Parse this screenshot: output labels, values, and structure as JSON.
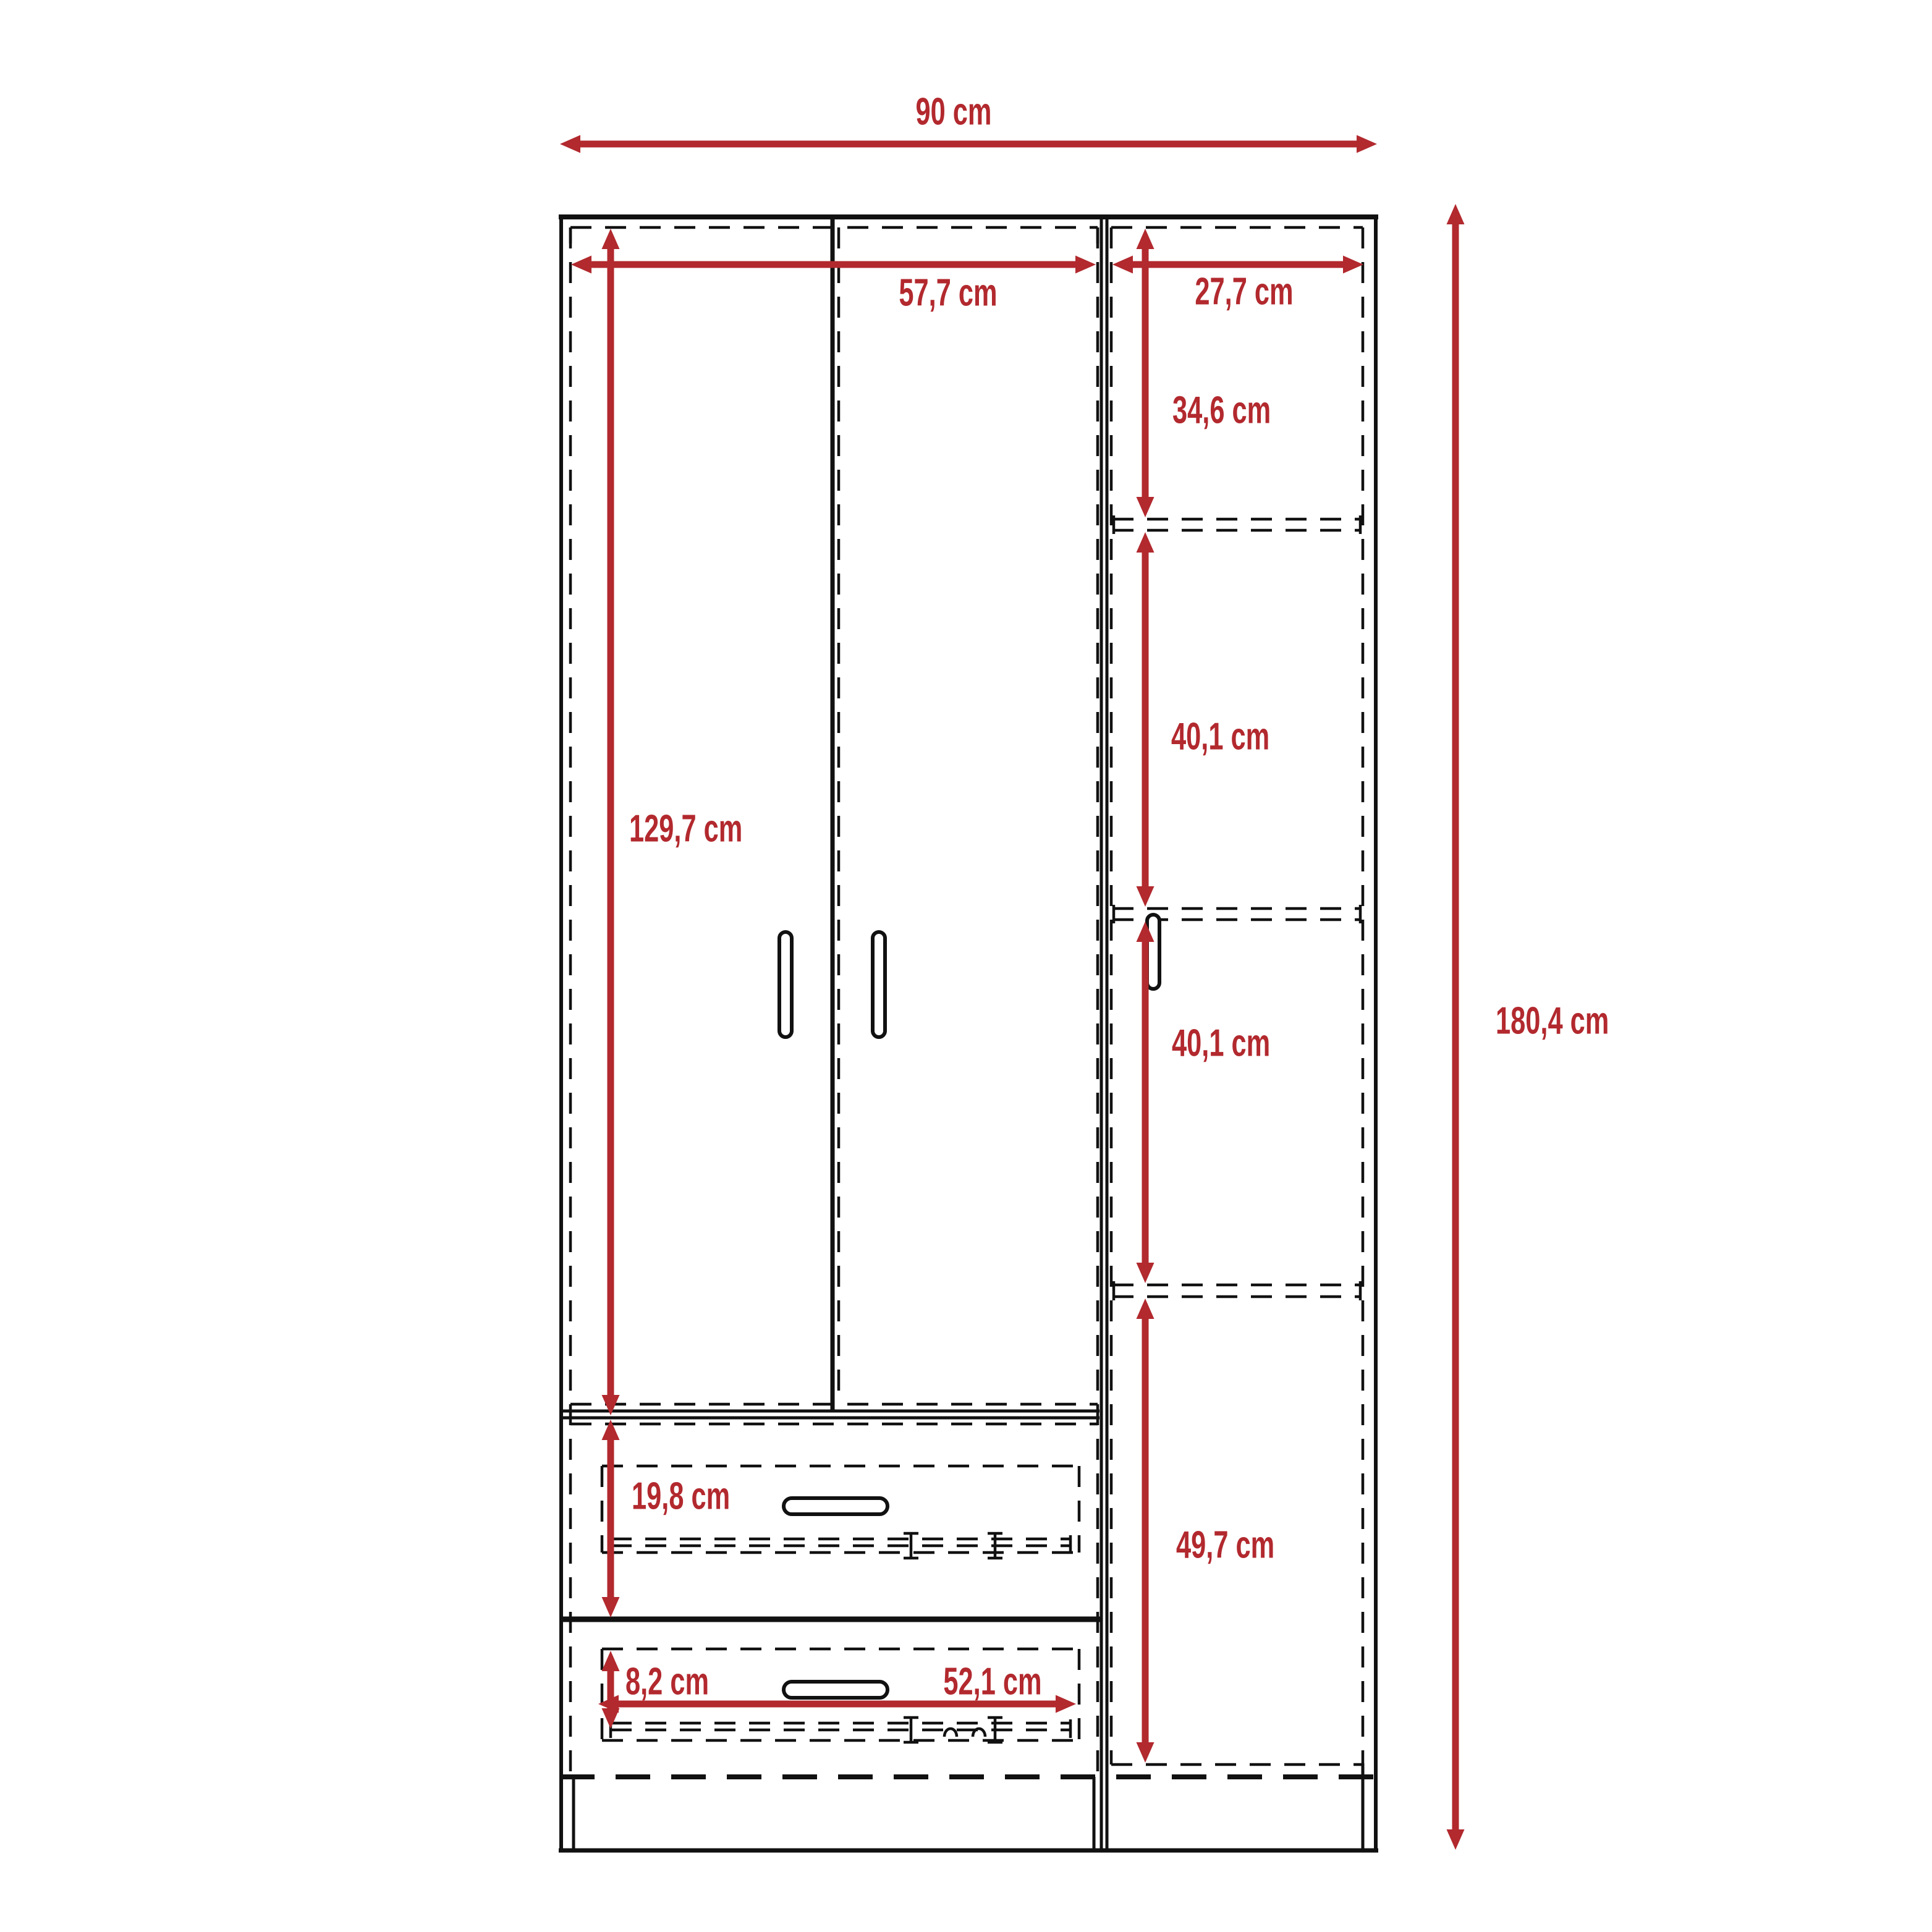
{
  "diagram": {
    "kind": "furniture dimension drawing",
    "subject": "three-door wardrobe with two drawers, front elevation",
    "accent_color": "#B2292E",
    "line_color": "#111111",
    "background_color": "#FFFFFF",
    "unit": "cm"
  },
  "dimensions": {
    "total_width": "90 cm",
    "left_section_width": "57,7 cm",
    "right_section_width": "27,7 cm",
    "right_shelf_top_height": "34,6 cm",
    "right_shelf_mid_height": "40,1 cm",
    "right_shelf_lower_height": "40,1 cm",
    "right_bottom_height": "49,7 cm",
    "door_height": "129,7 cm",
    "top_drawer_height": "19,8 cm",
    "bottom_drawer_front_height": "8,2 cm",
    "drawer_width": "52,1 cm",
    "total_height": "180,4 cm"
  }
}
